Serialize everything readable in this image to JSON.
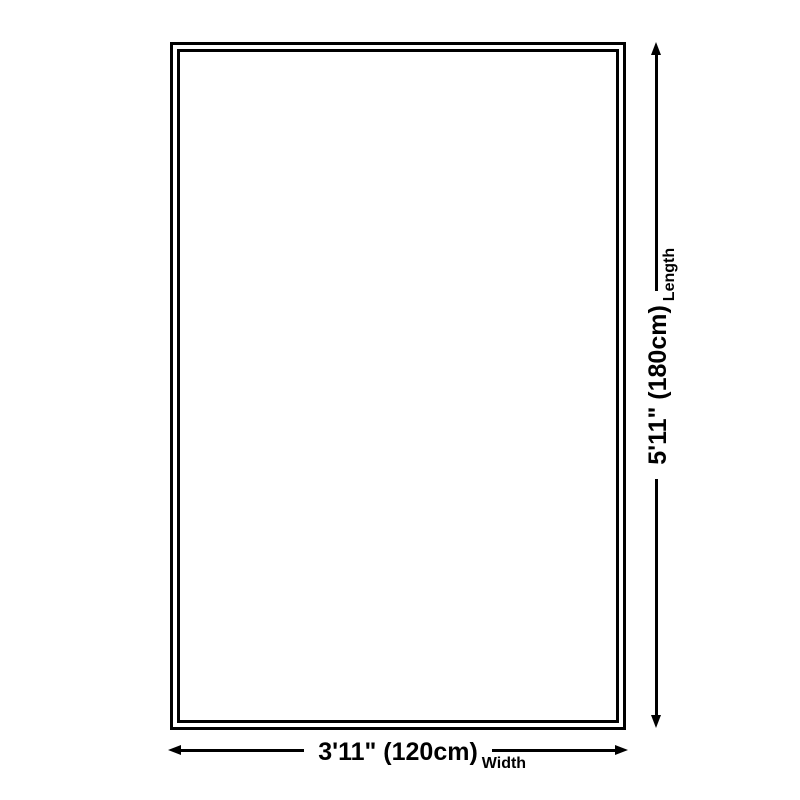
{
  "page": {
    "background_color": "#ffffff",
    "line_color": "#000000"
  },
  "diagram": {
    "type": "product-size-diagram",
    "item": "rug-outline",
    "width_dimension": {
      "value_label": "3'11\" (120cm)",
      "axis_label": "Width"
    },
    "length_dimension": {
      "value_label": "5'11\" (180cm)",
      "axis_label": "Length"
    }
  }
}
